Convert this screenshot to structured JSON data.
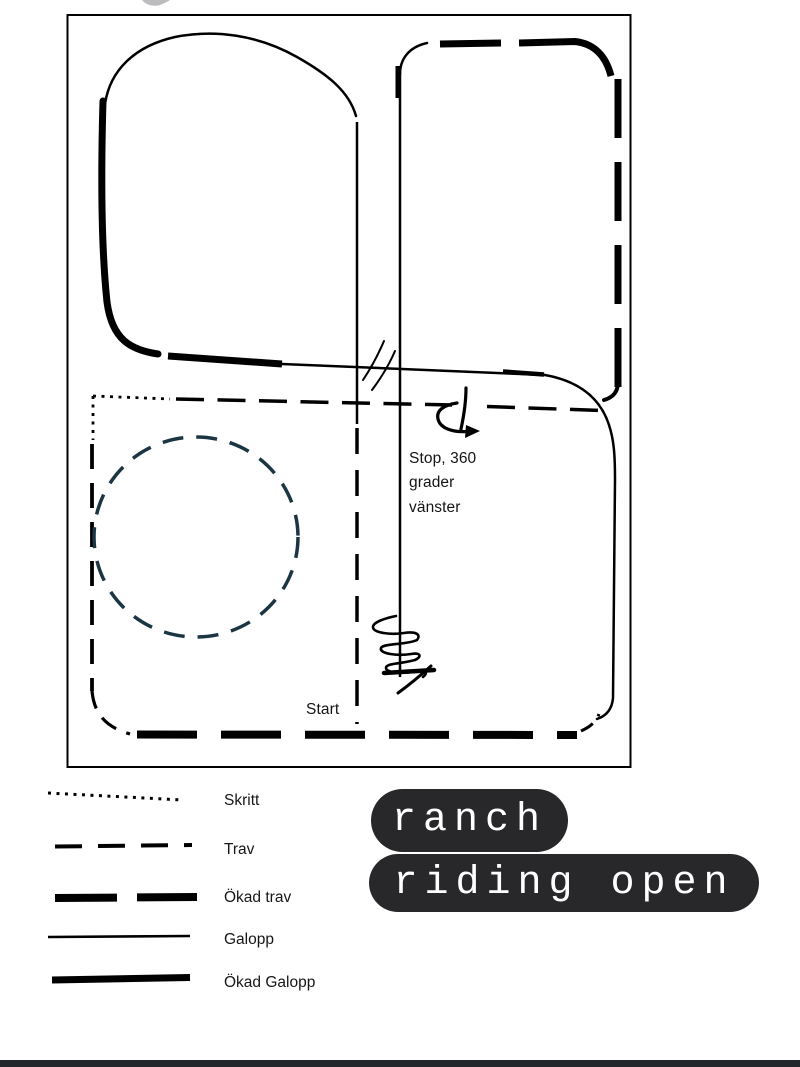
{
  "arena": {
    "stop_note": {
      "line1": "Stop, 360",
      "line2": "grader",
      "line3": "vänster"
    },
    "start_label": "Start"
  },
  "legend": {
    "items": [
      {
        "label": "Skritt",
        "style": "dotted"
      },
      {
        "label": "Trav",
        "style": "dashed"
      },
      {
        "label": "Ökad trav",
        "style": "thick-dashed"
      },
      {
        "label": "Galopp",
        "style": "thin-solid"
      },
      {
        "label": "Ökad Galopp",
        "style": "thick-solid"
      }
    ]
  },
  "badge": {
    "line1": "ranch",
    "line2": "riding open"
  },
  "colors": {
    "ink": "#000000",
    "circle_stroke": "#1b3542",
    "badge_bg": "#28282b",
    "badge_text": "#ffffff",
    "bottom_bar": "#23262b"
  }
}
